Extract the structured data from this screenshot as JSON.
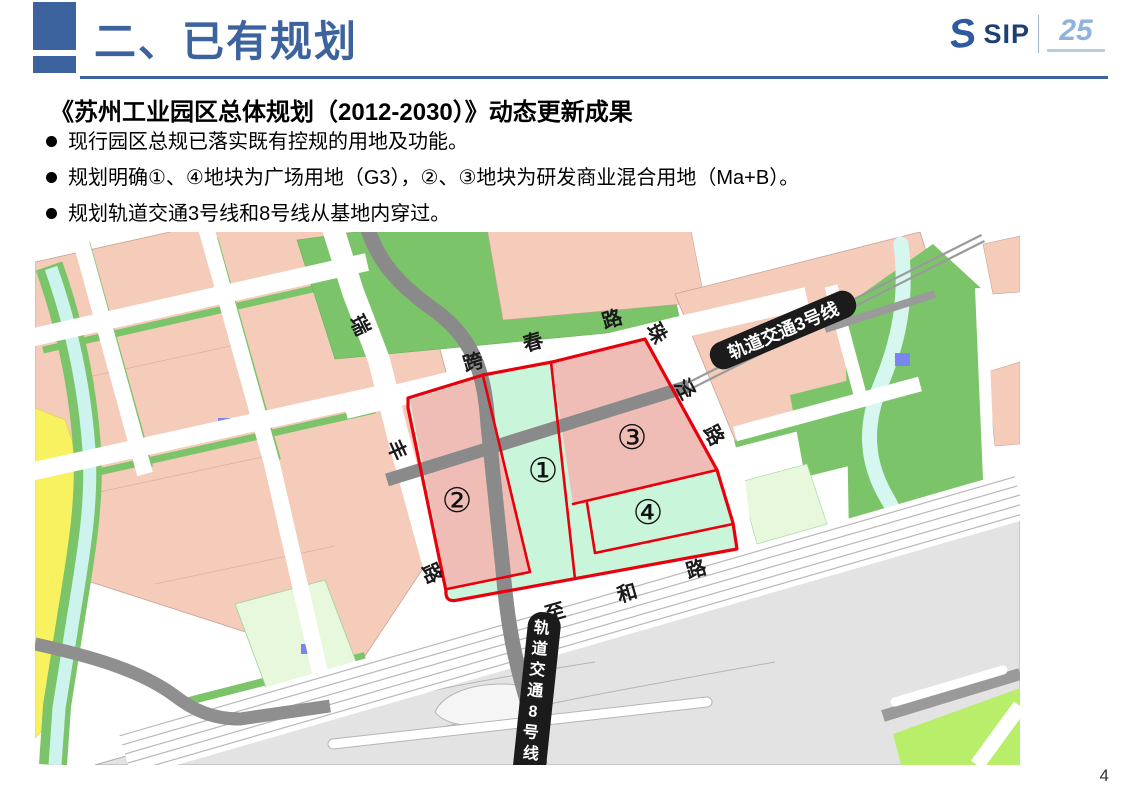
{
  "header": {
    "title": "二、已有规划",
    "logo": {
      "brand": "SIP",
      "anniversary": "25"
    }
  },
  "content": {
    "subtitle": "《苏州工业园区总体规划（2012-2030）》动态更新成果",
    "bullets": [
      "现行园区总规已落实既有控规的用地及功能。",
      "规划明确①、④地块为广场用地（G3），②、③地块为研发商业混合用地（Ma+B）。",
      "规划轨道交通3号线和8号线从基地内穿过。"
    ]
  },
  "map": {
    "roads": {
      "kuachun": [
        "跨",
        "春",
        "路"
      ],
      "rui": "瑞",
      "feng": [
        "丰",
        "路"
      ],
      "zhujing": [
        "珠",
        "泾",
        "路"
      ],
      "zhihe": [
        "至",
        "和",
        "路"
      ]
    },
    "rail": {
      "line3": "轨道交通3号线",
      "line8_chars": [
        "轨",
        "道",
        "交",
        "通",
        "8",
        "号",
        "线"
      ]
    },
    "parcels": [
      {
        "label": "①"
      },
      {
        "label": "②"
      },
      {
        "label": "③"
      },
      {
        "label": "④"
      }
    ],
    "colors": {
      "site_boundary_red": "#E8000D",
      "site_green": "#C9F5DA",
      "site_pink": "#EFBDB6",
      "block_pink": "#F5CBB9",
      "block_green": "#7CC46A",
      "pale_green": "#E7F8DC",
      "bright_green": "#B9EE6A",
      "yellow": "#F8F261",
      "water": "#CDF3EE",
      "road_gray": "#8A8A8A",
      "interchange_gray": "#E3E3E3",
      "rail_banner_black": "#1B1B1B"
    }
  },
  "slide": {
    "page_number": "4",
    "accent_blue": "#3d639e"
  }
}
